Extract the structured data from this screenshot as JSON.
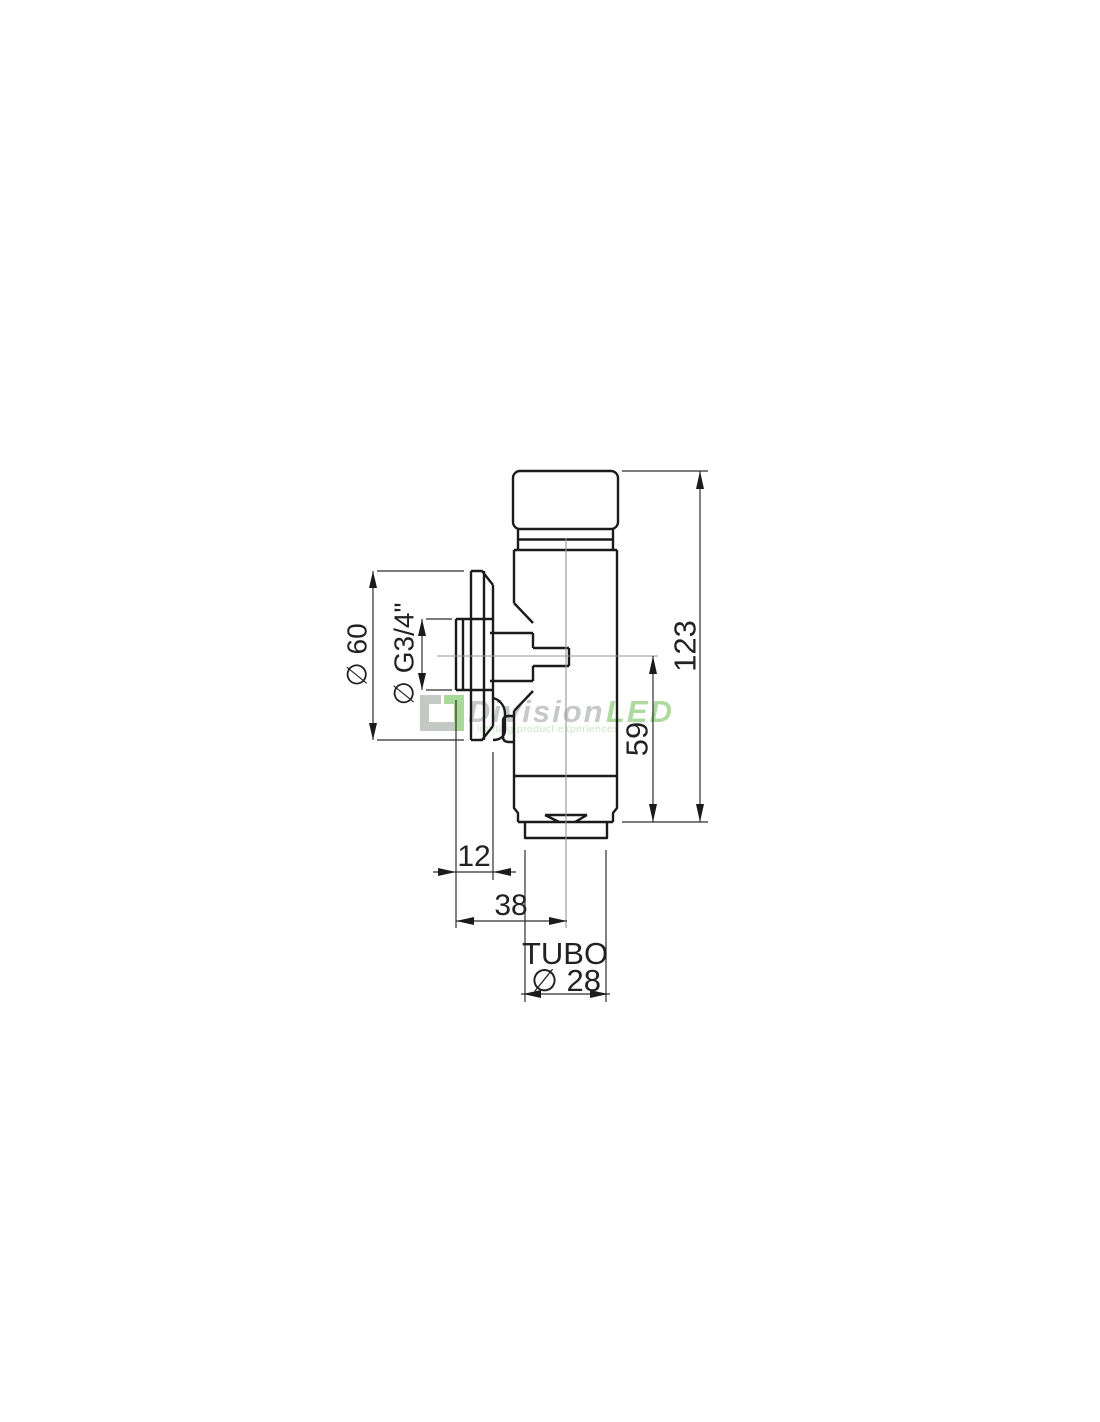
{
  "drawing": {
    "title": "flush-valve-technical-drawing",
    "labels": {
      "flange_diameter": "∅ 60",
      "thread_size": "∅ G3/4\"",
      "total_height": "123",
      "outlet_height": "59",
      "spigot_offset": "12",
      "wall_to_axis": "38",
      "tube_word": "TUBO",
      "tube_diameter": "∅ 28"
    }
  },
  "watermark": {
    "brand_primary": "Division",
    "brand_accent": "LED",
    "tagline": "lighting product experiences",
    "colors": {
      "primary": "#c6cac7",
      "accent": "#aeda9f",
      "tagline": "#cde8c6",
      "logo_gray": "#c5c9c6",
      "logo_green": "#a9d89b"
    }
  },
  "canvas": {
    "background": "#ffffff",
    "line_color": "#1b1b1b"
  }
}
